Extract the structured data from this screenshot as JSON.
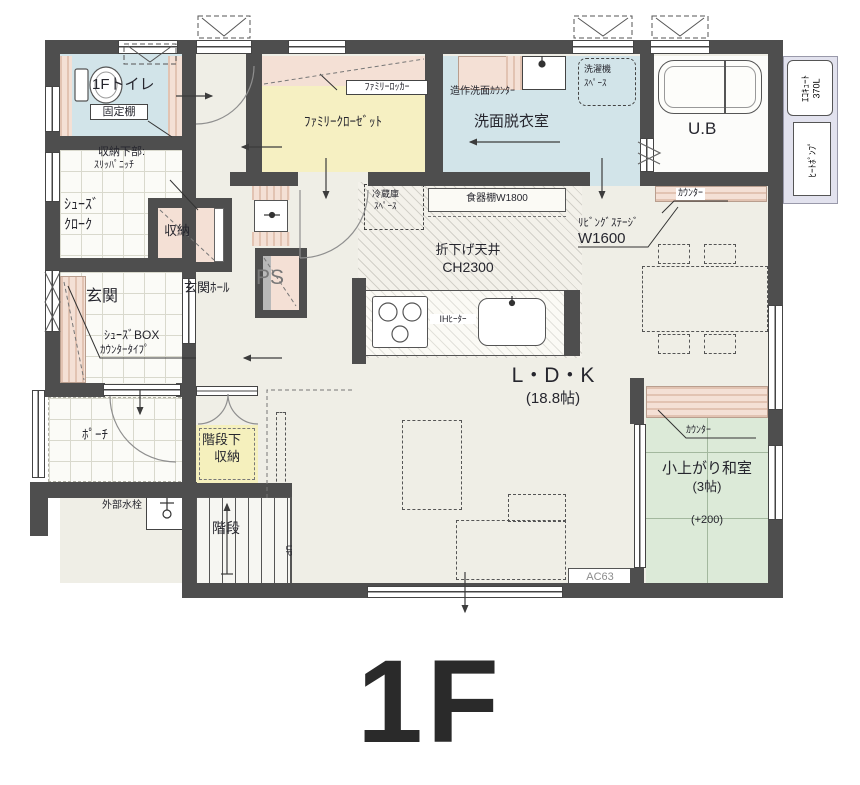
{
  "floor_title": "1F",
  "palette": {
    "wall": "#4e4e4e",
    "room_yellow": "#f6f0c2",
    "room_blue": "#d2e4e9",
    "tatami_green": "#dcead8",
    "counter_pink": "#f4e0d5",
    "equipment_lavender": "#e2e2ee"
  },
  "rooms": {
    "toilet": {
      "name": "1Fトイレ",
      "shelf_label": "固定棚"
    },
    "shoe_cloak": {
      "name_l1": "ｼｭｰｽﾞ",
      "name_l2": "ｸﾛｰｸ",
      "lower_l1": "収納下部:",
      "lower_l2": "ｽﾘｯﾊﾟﾆｯﾁ"
    },
    "storage": {
      "name": "収納"
    },
    "genkan": {
      "name": "玄関",
      "shoebox_l1": "ｼｭｰｽﾞBOX",
      "shoebox_l2": "ｶｳﾝﾀｰﾀｲﾌﾟ"
    },
    "hall": {
      "name": "玄関ﾎｰﾙ",
      "ps": "PS"
    },
    "porch": {
      "name": "ﾎﾟｰﾁ",
      "faucet": "外部水栓"
    },
    "stairs": {
      "name": "階段",
      "up": "UP",
      "under_l1": "階段下",
      "under_l2": "収納"
    },
    "family_closet": {
      "name": "ﾌｧﾐﾘｰｸﾛｰｾﾞｯﾄ",
      "locker": "ﾌｧﾐﾘｰﾛｯｶｰ"
    },
    "washroom": {
      "name": "洗面脱衣室",
      "counter": "造作洗面ｶｳﾝﾀｰ",
      "washer_l1": "洗濯機",
      "washer_l2": "ｽﾍﾟｰｽ"
    },
    "bath": {
      "name": "U.B"
    },
    "equipment": {
      "ecocute_l1": "ｴｺｷｭｰﾄ",
      "ecocute_l2": "370L",
      "heatpump": "ﾋｰﾄﾎﾟﾝﾌﾟ"
    },
    "kitchen": {
      "fridge_l1": "冷蔵庫",
      "fridge_l2": "ｽﾍﾟｰｽ",
      "cupboard": "食器棚W1800",
      "ih": "IHﾋｰﾀｰ",
      "ceiling_l1": "折下げ天井",
      "ceiling_l2": "CH2300"
    },
    "ldk": {
      "name": "L・D・K",
      "size": "(18.8帖)",
      "counter_top": "ｶｳﾝﾀｰ",
      "living_stage_l1": "ﾘﾋﾞﾝｸﾞｽﾃｰｼﾞ",
      "living_stage_l2": "W1600",
      "ac": "AC63"
    },
    "tatami": {
      "name": "小上がり和室",
      "size": "(3帖)",
      "height": "(+200)",
      "counter": "ｶｳﾝﾀｰ"
    }
  }
}
